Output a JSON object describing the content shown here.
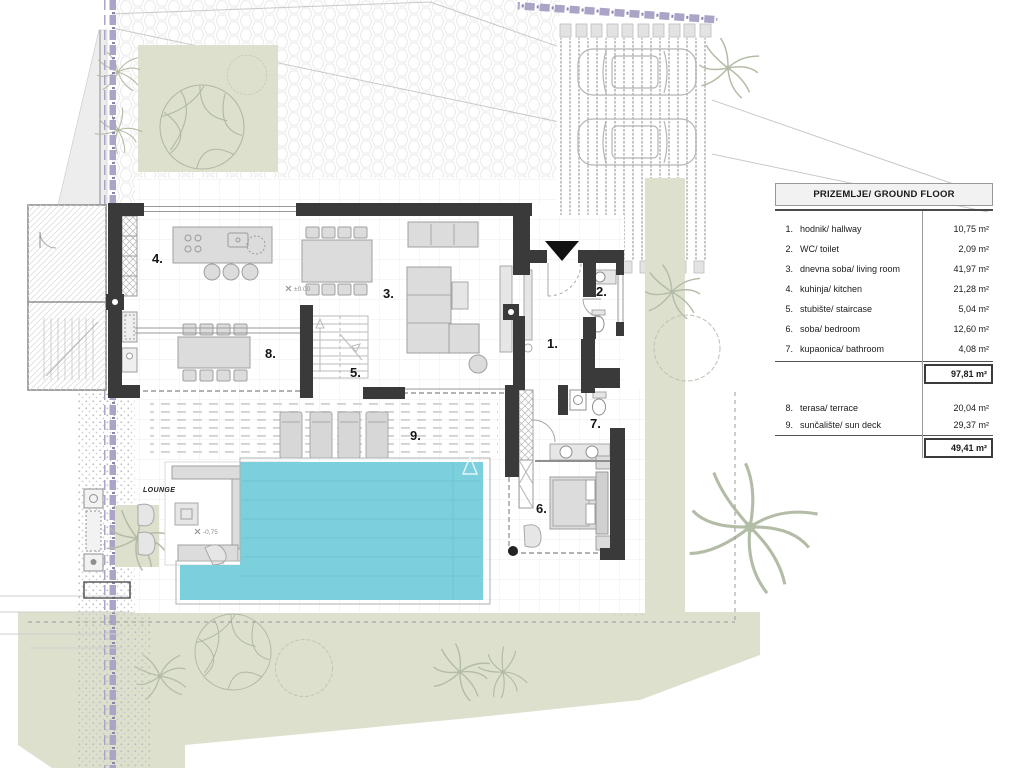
{
  "plan": {
    "labels": {
      "hallway_no": "1.",
      "wc_no": "2.",
      "living_no": "3.",
      "kitchen_no": "4.",
      "staircase_no": "5.",
      "bedroom_no": "6.",
      "bathroom_no": "7.",
      "terrace_no": "8.",
      "sundeck_no": "9.",
      "lounge": "LOUNGE",
      "level_main": "±0.00",
      "level_lounge": "-0,75"
    },
    "colors": {
      "pool": "#7ccfdd",
      "lawn": "#dce0cd",
      "boundary": "#aba4c7",
      "wall": "#3a3a3a",
      "furniture": "#dcdcdc"
    }
  },
  "legend": {
    "title": "PRIZEMLJE/ GROUND FLOOR",
    "rows": [
      {
        "no": "1.",
        "name": "hodnik/ hallway",
        "area": "10,75 m²"
      },
      {
        "no": "2.",
        "name": "WC/ toilet",
        "area": "2,09 m²"
      },
      {
        "no": "3.",
        "name": "dnevna soba/ living room",
        "area": "41,97 m²"
      },
      {
        "no": "4.",
        "name": "kuhinja/ kitchen",
        "area": "21,28 m²"
      },
      {
        "no": "5.",
        "name": "stubište/ staircase",
        "area": "5,04 m²"
      },
      {
        "no": "6.",
        "name": "soba/ bedroom",
        "area": "12,60 m²"
      },
      {
        "no": "7.",
        "name": "kupaonica/ bathroom",
        "area": "4,08 m²"
      }
    ],
    "subtotal_indoor": "97,81 m²",
    "outdoor_rows": [
      {
        "no": "8.",
        "name": "terasa/ terrace",
        "area": "20,04 m²"
      },
      {
        "no": "9.",
        "name": "sunčalište/ sun deck",
        "area": "29,37 m²"
      }
    ],
    "subtotal_outdoor": "49,41 m²"
  }
}
